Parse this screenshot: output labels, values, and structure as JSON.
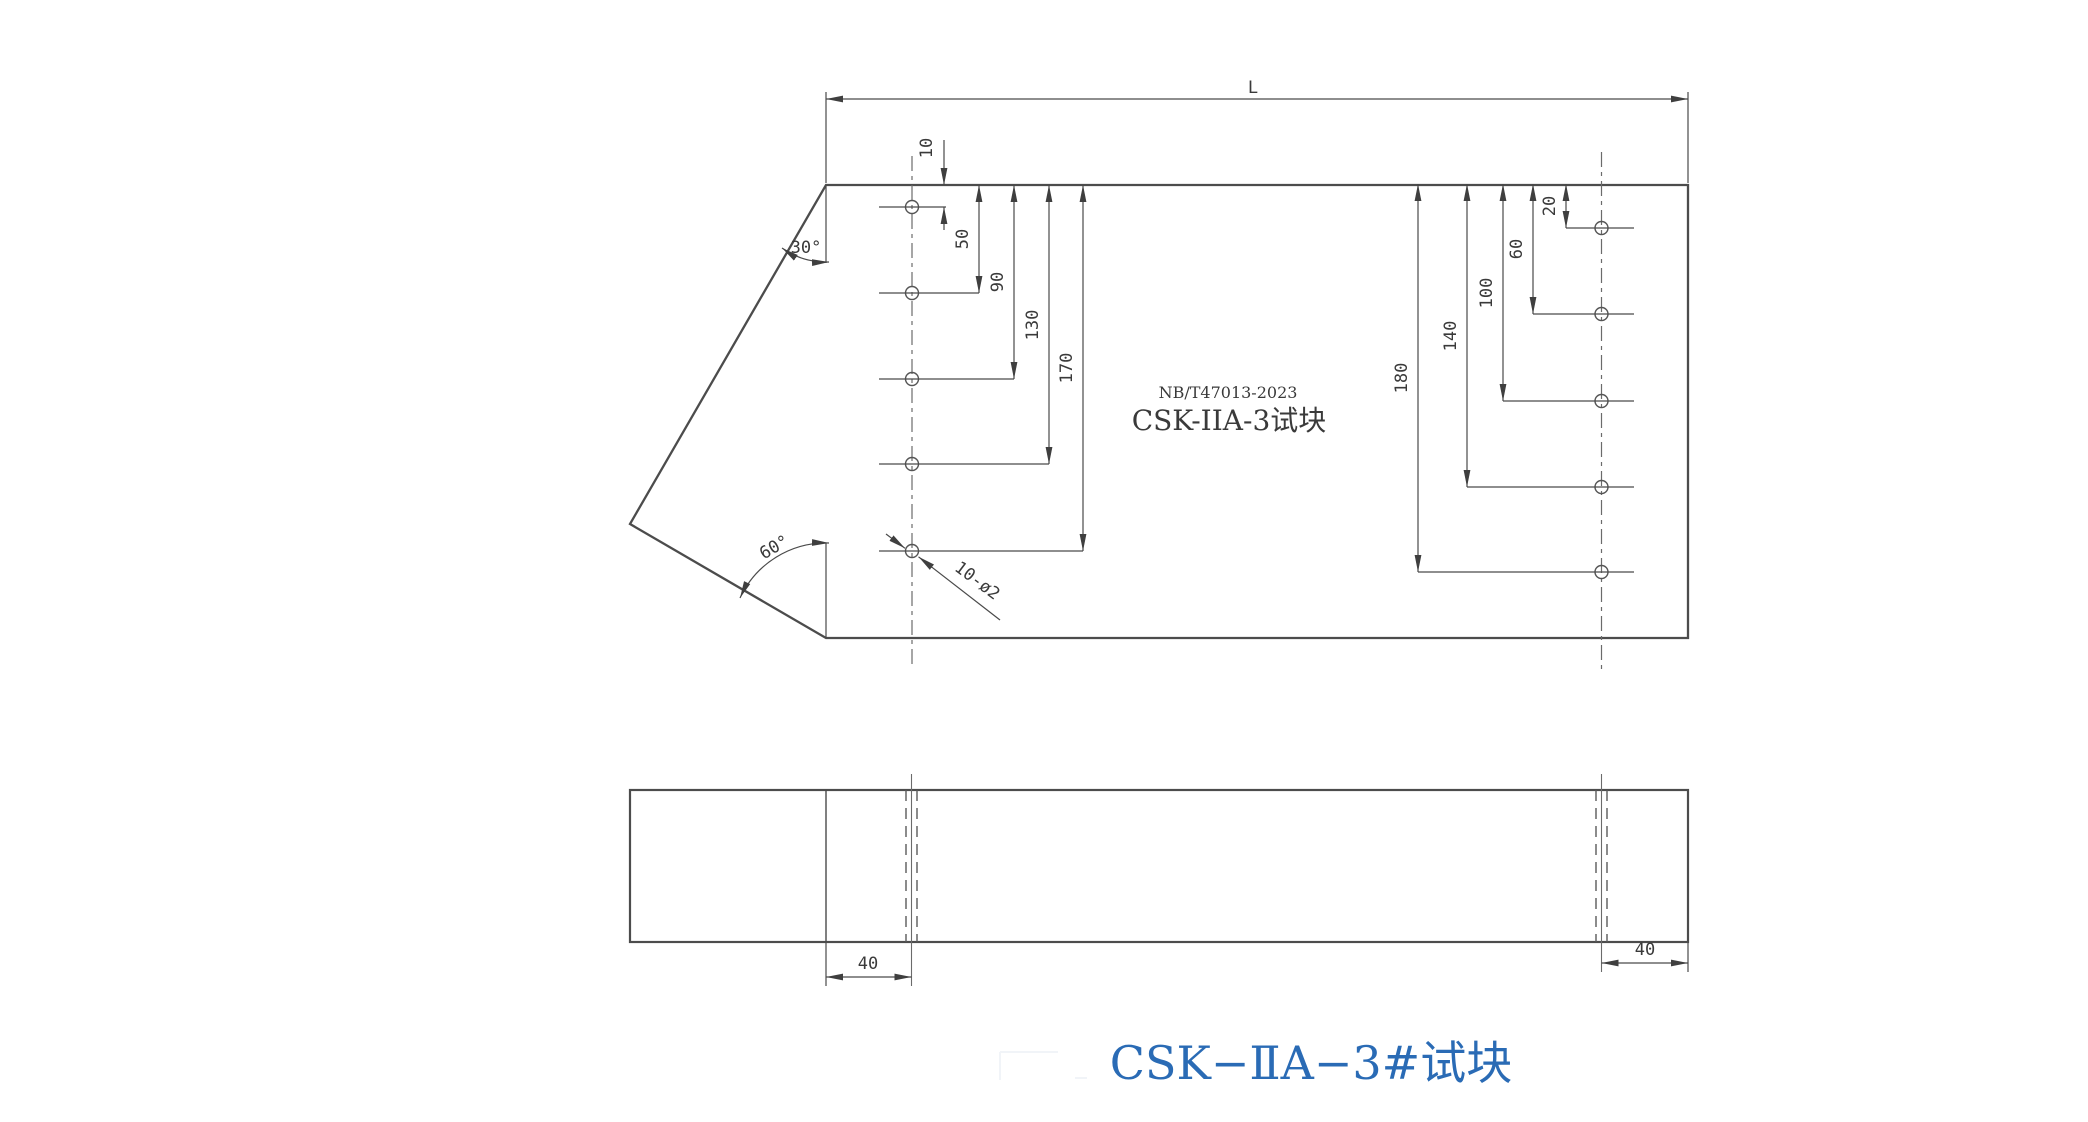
{
  "drawing": {
    "top_view": {
      "length_label": "L",
      "standard": "NB/T47013-2023",
      "block_name": "CSK-IIA-3试块",
      "left_hole_depths": [
        "10",
        "50",
        "90",
        "130",
        "170"
      ],
      "right_hole_depths": [
        "20",
        "60",
        "100",
        "140",
        "180"
      ],
      "holes_note": "10-ø2",
      "angle_top": "30°",
      "angle_bottom": "60°"
    },
    "front_view": {
      "offset_left": "40",
      "offset_right": "40"
    },
    "caption": "CSK−ⅡA−3#试块",
    "colors": {
      "line": "#4c4c4c",
      "caption_blue": "#2a6bb5"
    }
  }
}
